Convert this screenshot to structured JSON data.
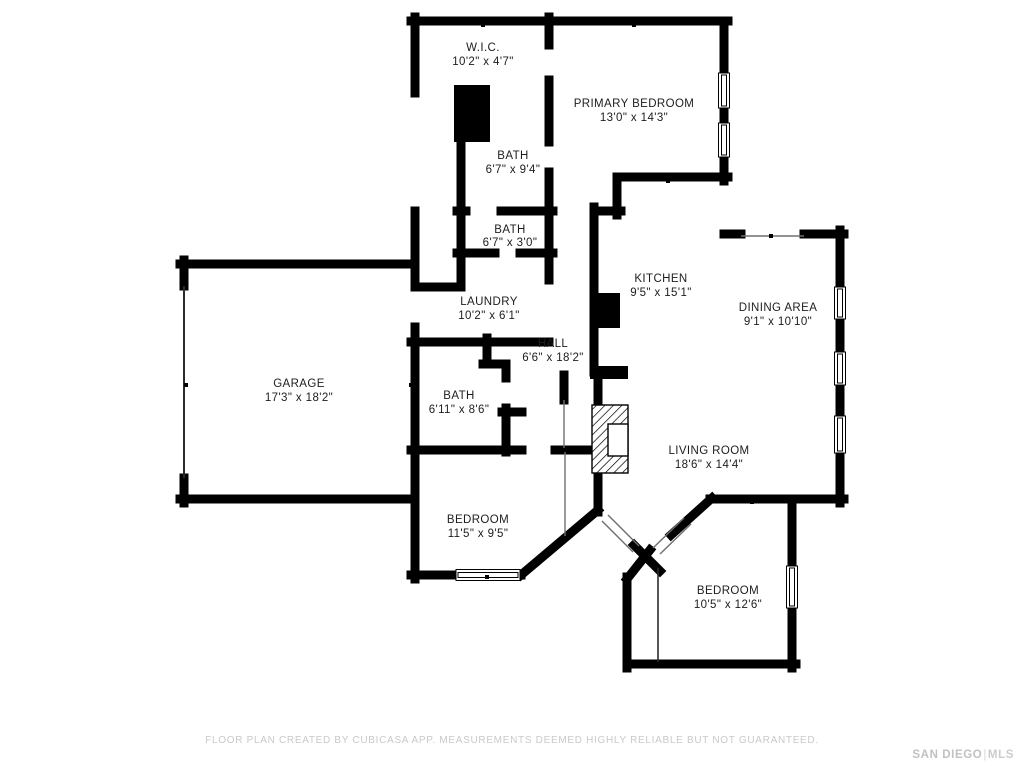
{
  "rooms": [
    {
      "name": "W.I.C.",
      "dims": "10'2\" x 4'7\""
    },
    {
      "name": "PRIMARY BEDROOM",
      "dims": "13'0\" x 14'3\""
    },
    {
      "name": "BATH",
      "dims": "6'7\" x 9'4\""
    },
    {
      "name": "BATH",
      "dims": "6'7\" x 3'0\""
    },
    {
      "name": "KITCHEN",
      "dims": "9'5\" x 15'1\""
    },
    {
      "name": "DINING AREA",
      "dims": "9'1\" x 10'10\""
    },
    {
      "name": "LAUNDRY",
      "dims": "10'2\" x 6'1\""
    },
    {
      "name": "HALL",
      "dims": "6'6\" x 18'2\""
    },
    {
      "name": "GARAGE",
      "dims": "17'3\" x 18'2\""
    },
    {
      "name": "BATH",
      "dims": "6'11\" x 8'6\""
    },
    {
      "name": "LIVING ROOM",
      "dims": "18'6\" x 14'4\""
    },
    {
      "name": "BEDROOM",
      "dims": "11'5\" x 9'5\""
    },
    {
      "name": "BEDROOM",
      "dims": "10'5\" x 12'6\""
    }
  ],
  "footer": {
    "disclaimer": "FLOOR PLAN CREATED BY CUBICASA APP. MEASUREMENTS DEEMED HIGHLY RELIABLE BUT NOT GUARANTEED.",
    "brand_primary": "SAN DIEGO",
    "brand_separator": "|",
    "brand_secondary": "MLS"
  },
  "colors": {
    "wall": "#000000",
    "background": "#ffffff",
    "label_text": "#1d1d1d",
    "opening_line": "#6e6e6e",
    "footer_text": "#c9c9c9",
    "brand_text": "#c1c1c1"
  }
}
